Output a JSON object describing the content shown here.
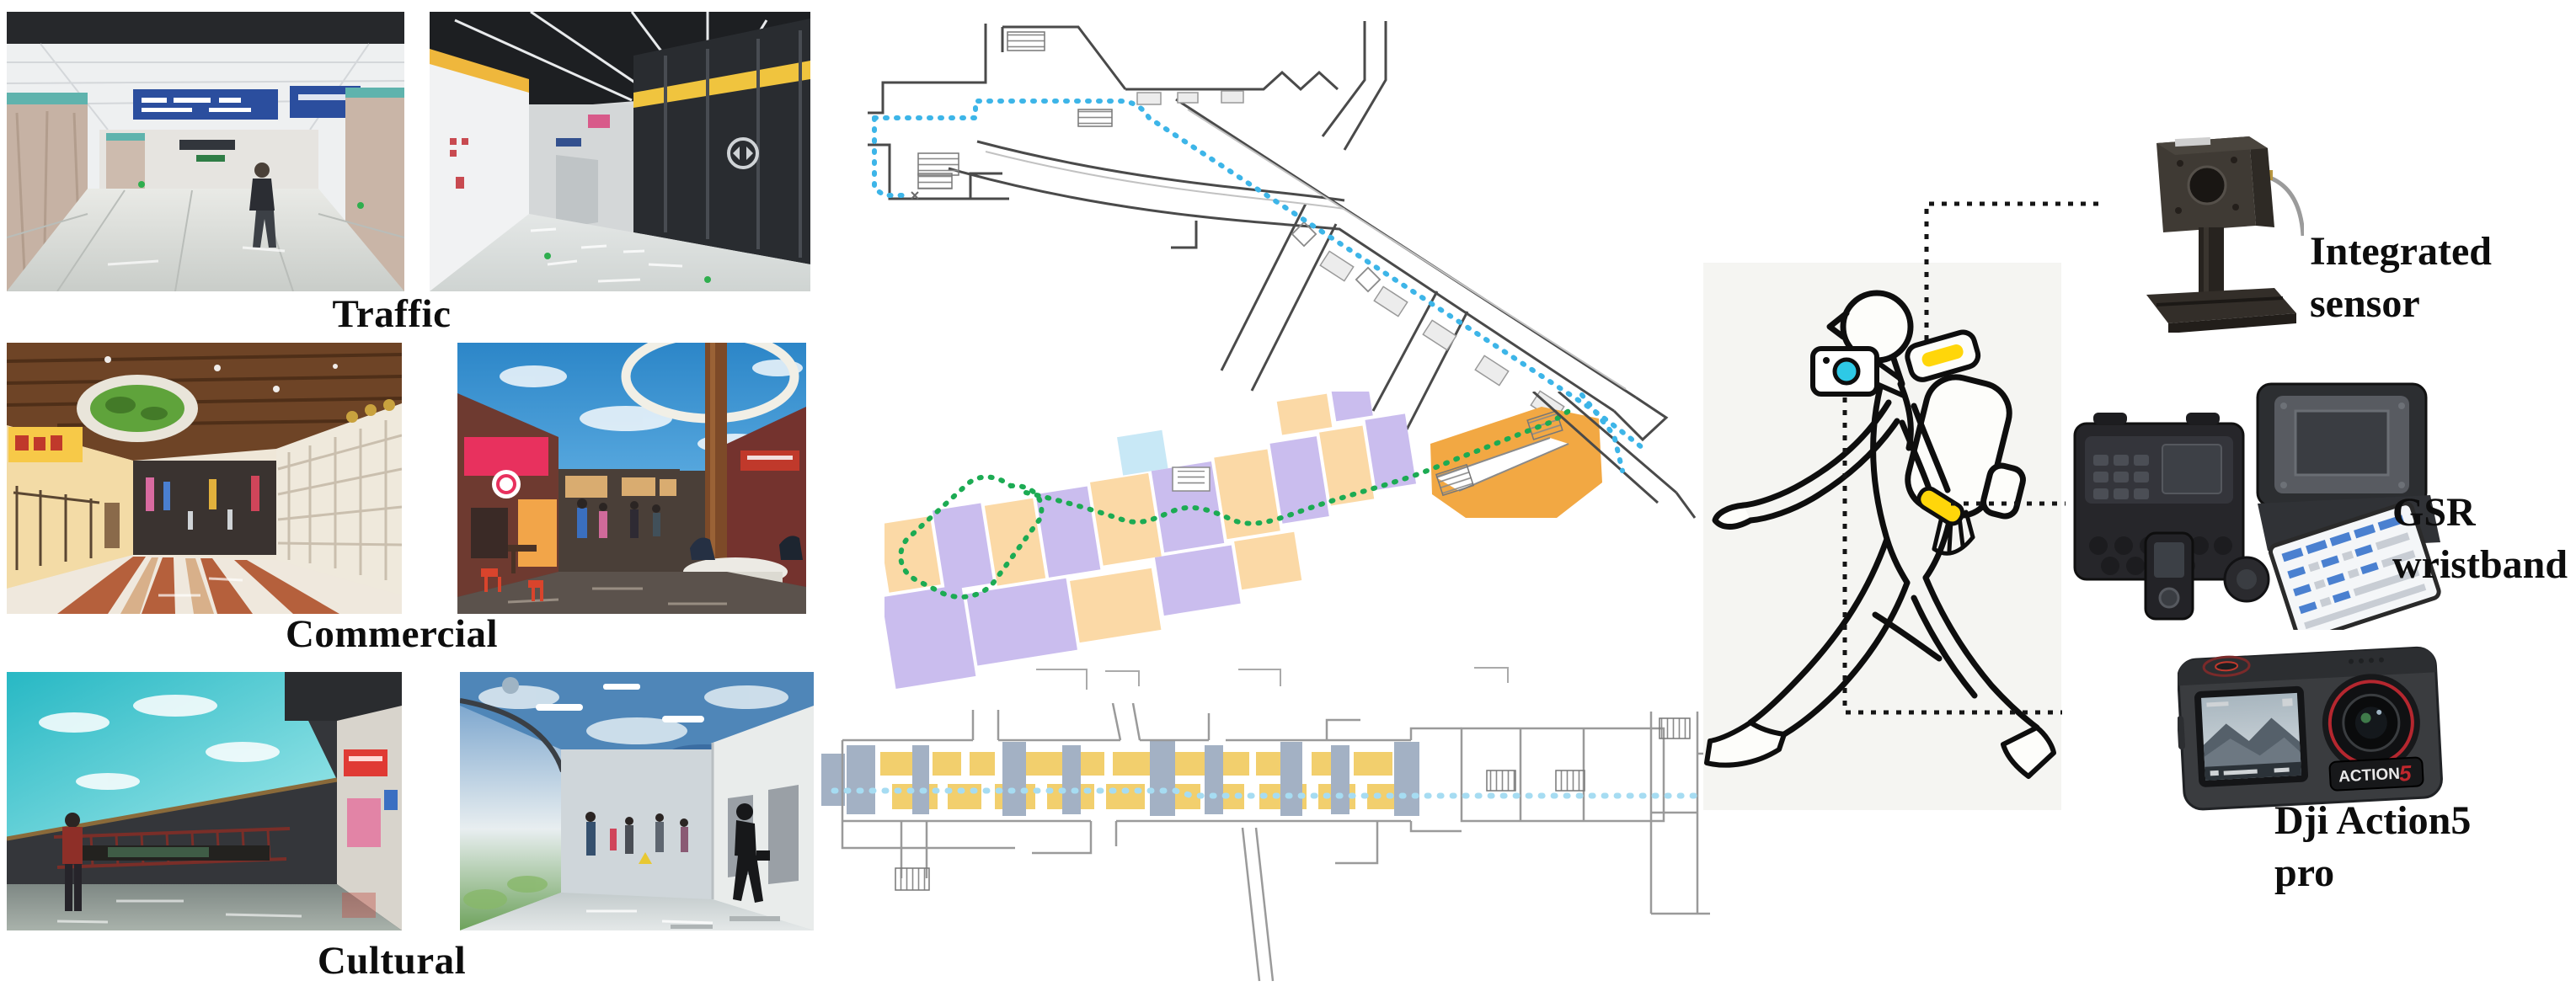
{
  "figure": {
    "categories": [
      {
        "label": "Traffic"
      },
      {
        "label": "Commercial"
      },
      {
        "label": "Cultural"
      }
    ],
    "equipment": [
      {
        "line1": "Integrated",
        "line2": "sensor"
      },
      {
        "line1": "GSR",
        "line2": "wristband"
      },
      {
        "line1": "Dji Action5",
        "line2": "pro"
      }
    ],
    "camera_badge": {
      "text": "ACTION",
      "number": "5"
    },
    "routes": {
      "traffic_route_color": "#3db5e8",
      "commercial_route_color": "#1cab53",
      "cultural_route_color": "#a6dcf2"
    },
    "palette": {
      "map_purple": "#cabdee",
      "map_peach": "#fbd9a6",
      "map_orange": "#f2a843",
      "map_yellow": "#f2cf6d",
      "map_bluegray": "#a3b1c4",
      "device_yellow": "#ffd60a",
      "camera_lens_cyan": "#2ec9e6",
      "lens_ring_red": "#b5272f"
    }
  }
}
